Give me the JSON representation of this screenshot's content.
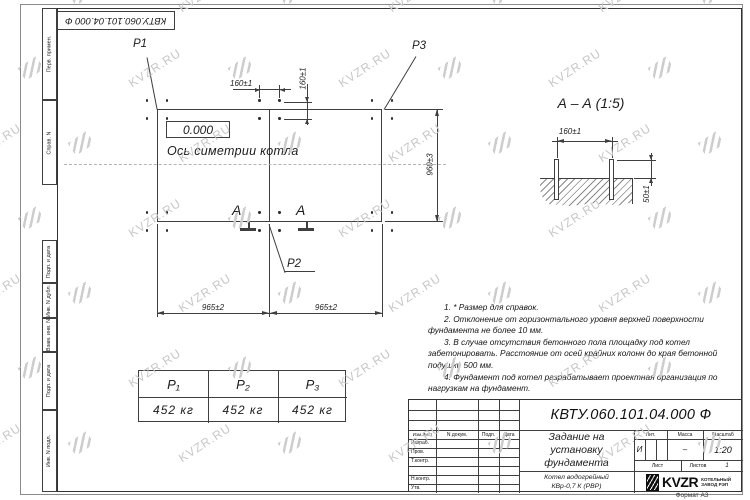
{
  "stamp": {
    "corner_doc_number": "КВТУ.060.101.04.000  Ф"
  },
  "frame_labels": [
    "Перв. примен.",
    "Справ. N",
    "Подп. и дата",
    "Инв. N дубл.",
    "Взам. инв. N",
    "Подп. и дата",
    "Инв. N подл."
  ],
  "watermark": {
    "text": "KVZR.RU"
  },
  "plan": {
    "label_p1": "P1",
    "label_p2": "P2",
    "label_p3": "P3",
    "datum": "0.000",
    "axis_label": "Ось симетрии котла",
    "dim_bolt_h": "160±1",
    "dim_bolt_v": "160±1",
    "dim_height": "960±3",
    "dim_width_left": "965±2",
    "dim_width_right": "965±2",
    "section_mark_left": "А",
    "section_mark_right": "А"
  },
  "section_view": {
    "title": "А – А (1:5)",
    "dim_bolts": "160±1",
    "dim_protrusion": "50±1"
  },
  "notes": [
    "1. * Размер для справок.",
    "2. Отклонение от горизонтального уровня верхней поверхности фундамента не более 10 мм.",
    "3. В случае отсутствия бетонного пола площадку под котел забетонировать. Расстояние от осей крайних колонн до края бетонной подушки 500 мм.",
    "4. Фундамент под котел разрабатывает проектная организация по нагрузкам на фундамент."
  ],
  "load_table": {
    "headers": [
      "Р₁",
      "Р₂",
      "Р₃"
    ],
    "values": [
      "452 кг",
      "452 кг",
      "452 кг"
    ]
  },
  "title_block": {
    "doc_number": "КВТУ.060.101.04.000  Ф",
    "title_lines": [
      "Задание на",
      "установку",
      "фундамента"
    ],
    "product_lines": [
      "Котел водогрейный",
      "КВр-0,7 К (РВР)"
    ],
    "col_headers": [
      "Изм.Лист",
      "N докум.",
      "Подп.",
      "Дата"
    ],
    "row_labels": [
      "Разраб.",
      "Пров.",
      "Т.контр.",
      "",
      "Н.контр.",
      "Утв."
    ],
    "lit_header": "Лит.",
    "lit_value": "И",
    "mass_header": "Масса",
    "mass_value": "–",
    "scale_header": "Масштаб",
    "scale_value": "1:20",
    "sheet_header": "Лист",
    "sheets_header": "Листов",
    "sheets_value": "1",
    "company": {
      "name": "KVZR",
      "line1": "КОТЕЛЬНЫЙ",
      "line2": "ЗАВОД РЭП"
    },
    "format_label": "Формат А3"
  }
}
